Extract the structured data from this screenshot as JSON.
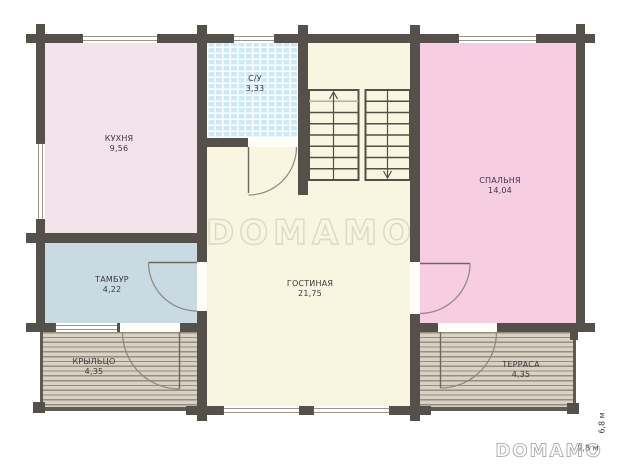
{
  "plan_title": "first-floor-plan",
  "rooms": {
    "kitchen": {
      "label": "КУХНЯ",
      "area": "9,56",
      "color": "#f3e4eb"
    },
    "bathroom": {
      "label": "С/У",
      "area": "3,33",
      "color": "#cde9f8"
    },
    "living": {
      "label": "ГОСТИНАЯ",
      "area": "21,75",
      "color": "#f8f5e1"
    },
    "bedroom": {
      "label": "СПАЛЬНЯ",
      "area": "14,04",
      "color": "#f7cde2"
    },
    "vestibule": {
      "label": "ТАМБУР",
      "area": "4,22",
      "color": "#c9dbe2"
    },
    "porch": {
      "label": "КРЫЛЬЦО",
      "area": "4,35",
      "color": "#d8d1c4"
    },
    "terrace": {
      "label": "ТЕРРАСА",
      "area": "4,35",
      "color": "#d8d1c4"
    }
  },
  "dimensions": {
    "height_label": "6,8 м",
    "width_label": "9,8 м"
  },
  "branding": {
    "watermark": "DOMAMO",
    "logo": "DOMAMO"
  },
  "colors": {
    "wall": "#55504a",
    "background": "#ffffff",
    "label_text": "#3a3a3a",
    "tile_base": "#cde9f8",
    "tile_grid": "#ffffff",
    "deck_stripe": "#968f81",
    "stair_lines": "#544f47",
    "door_lines": "#8c867c",
    "watermark_stroke": "#dcd9c2",
    "logo_stroke": "#b3b3b3"
  }
}
